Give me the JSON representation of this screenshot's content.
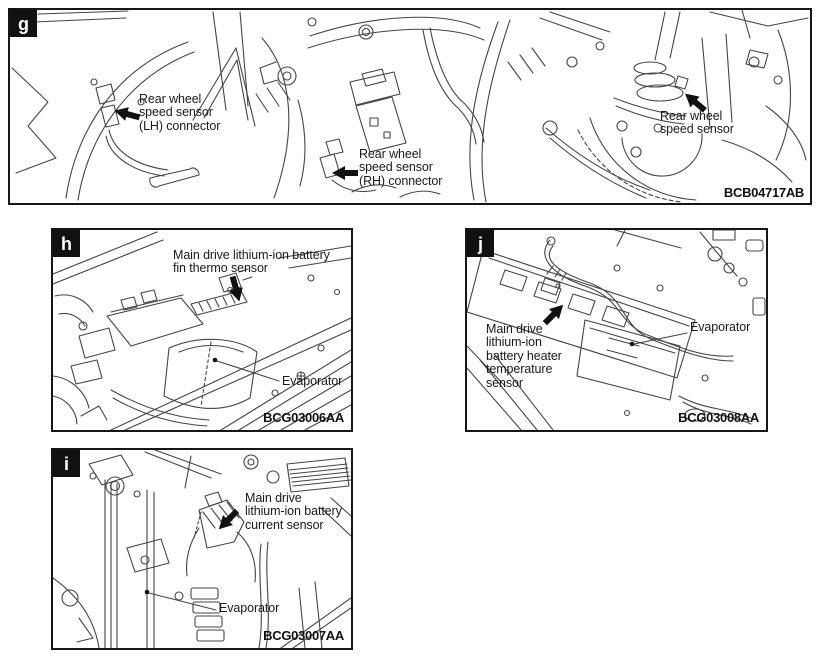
{
  "colors": {
    "ink": "#1a1a1a",
    "line": "#454545",
    "badge_bg": "#111111"
  },
  "panels": {
    "g": {
      "letter": "g",
      "code": "BCB04717AB",
      "callout_lh": "Rear wheel\nspeed sensor\n(LH) connector",
      "callout_rh": "Rear wheel\nspeed sensor\n(RH) connector",
      "callout_sensor": "Rear wheel\nspeed sensor"
    },
    "h": {
      "letter": "h",
      "code": "BCG03006AA",
      "callout_sensor": "Main drive lithium-ion battery\nfin thermo sensor",
      "callout_evaporator": "Evaporator"
    },
    "i": {
      "letter": "i",
      "code": "BCG03007AA",
      "callout_sensor": "Main drive\nlithium-ion battery\ncurrent sensor",
      "callout_evaporator": "Evaporator"
    },
    "j": {
      "letter": "j",
      "code": "BCG03008AA",
      "callout_sensor": "Main drive\nlithium-ion\nbattery heater\ntemperature\nsensor",
      "callout_evaporator": "Evaporator"
    }
  }
}
